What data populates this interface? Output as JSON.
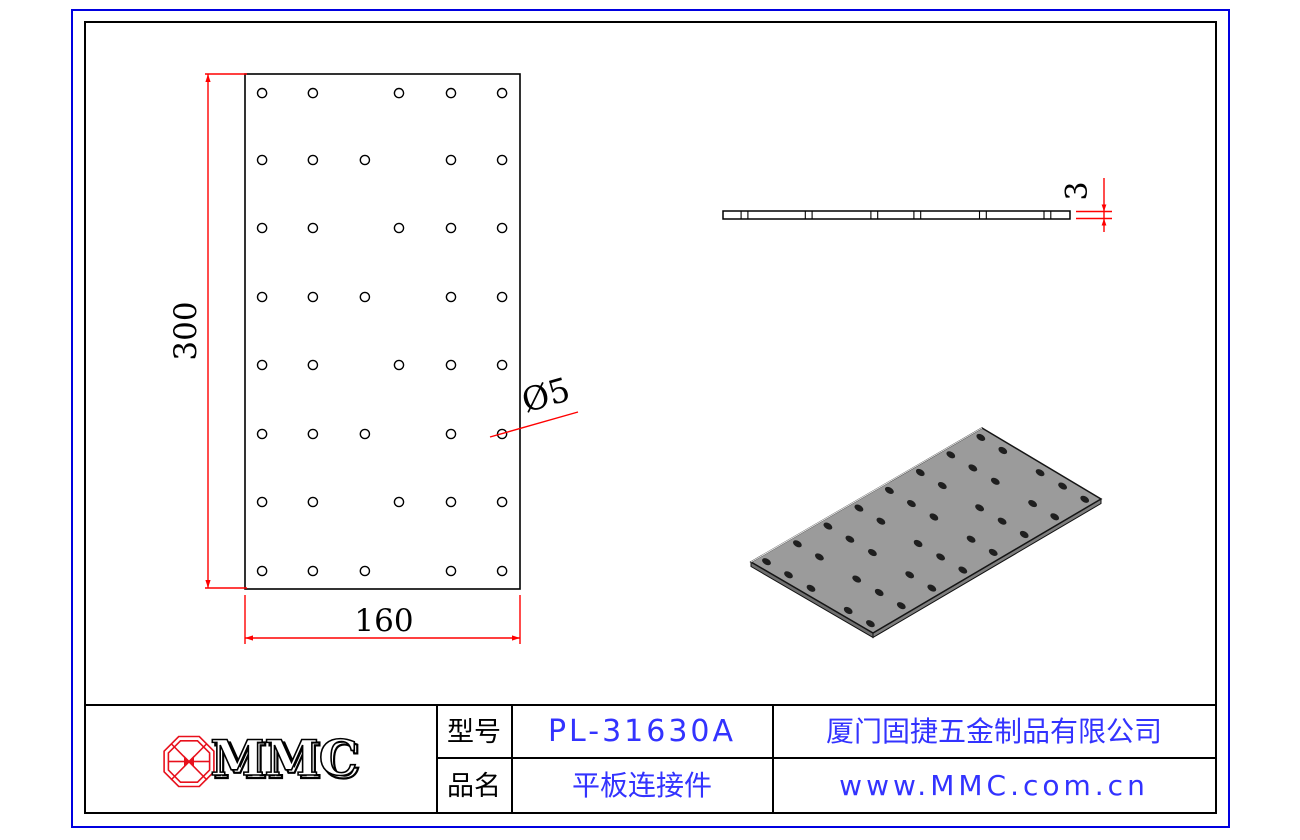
{
  "sheet": {
    "border_color_outer": "#0000e0",
    "border_color_inner": "#000000",
    "dimension_color": "#ff0000",
    "logo_color": "#e8101c",
    "text_blue": "#3333ff",
    "plate_gray": "#9b9b9b"
  },
  "drawing": {
    "dim_height": "300",
    "dim_width": "160",
    "dim_thickness": "3",
    "hole_diameter_label": "Ø5"
  },
  "title_block": {
    "logo_text": "MMC",
    "model_label": "型号",
    "model_value": "PL-31630A",
    "name_label": "品名",
    "name_value": "平板连接件",
    "company": "厦门固捷五金制品有限公司",
    "website": "www.MMC.com.cn"
  },
  "geometry": {
    "plan": {
      "x": 245,
      "y": 74,
      "w": 275,
      "h": 515,
      "hole_r": 4.6
    },
    "cols_u": [
      0.062,
      0.247,
      0.436,
      0.56,
      0.749,
      0.935
    ],
    "rows_v": [
      0.037,
      0.167,
      0.299,
      0.433,
      0.565,
      0.699,
      0.831,
      0.965
    ],
    "row_cols": [
      [
        0,
        1,
        3,
        4,
        5
      ],
      [
        0,
        1,
        2,
        4,
        5
      ],
      [
        0,
        1,
        3,
        4,
        5
      ],
      [
        0,
        1,
        2,
        4,
        5
      ],
      [
        0,
        1,
        3,
        4,
        5
      ],
      [
        0,
        1,
        2,
        4,
        5
      ],
      [
        0,
        1,
        3,
        4,
        5
      ],
      [
        0,
        1,
        2,
        4,
        5
      ]
    ],
    "side": {
      "x": 723,
      "y": 211,
      "w": 347,
      "h": 8,
      "tick_half_gap": 3.4
    },
    "iso": {
      "T": [
        982,
        428
      ],
      "R": [
        1101,
        499
      ],
      "L": [
        751,
        562
      ],
      "B": [
        873,
        633
      ],
      "thickness": 4.5,
      "hole_rx": 4.8,
      "hole_ry": 3.0,
      "hole_angle": 31
    }
  }
}
